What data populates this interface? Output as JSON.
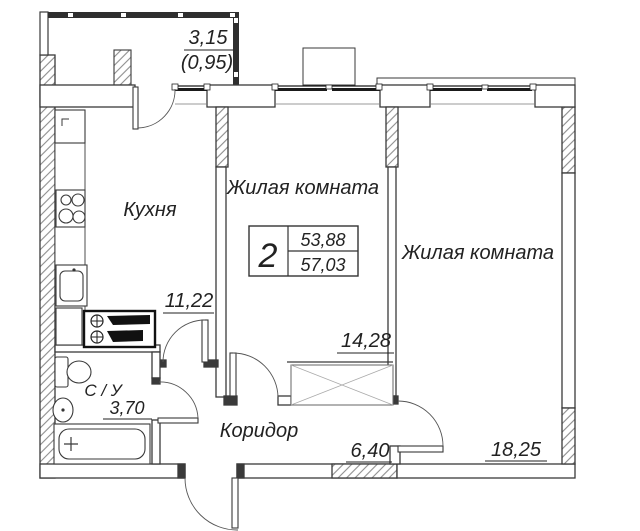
{
  "type_box": {
    "rooms_count": "2",
    "area_living": "53,88",
    "area_total": "57,03"
  },
  "labels": {
    "kitchen": "Кухня",
    "living1": "Жилая комната",
    "living2": "Жилая комната",
    "corridor": "Коридор",
    "bathroom": "С / У"
  },
  "areas": {
    "kitchen": "11,22",
    "living1": "14,28",
    "living2": "18,25",
    "corridor": "6,40",
    "bathroom": "3,70",
    "balcony_width": "3,15",
    "balcony_area": "(0,95)"
  },
  "colors": {
    "line": "#3a3a3a",
    "window": "#1a1a1a",
    "background": "#ffffff"
  }
}
